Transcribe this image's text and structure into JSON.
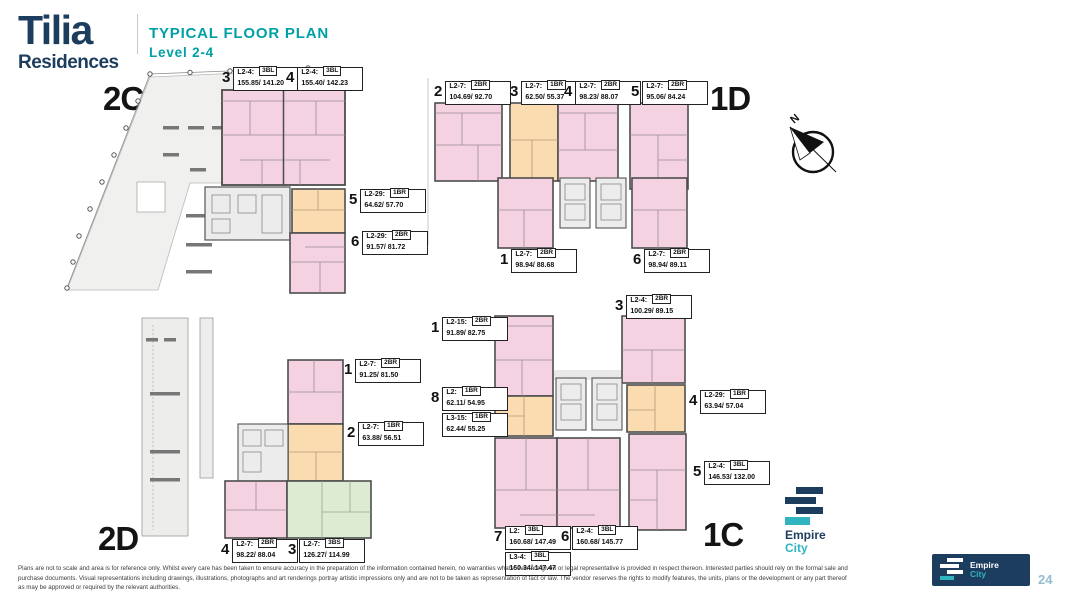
{
  "header": {
    "brand_name": "Tilia",
    "brand_sub": "Residences",
    "title": "TYPICAL FLOOR PLAN",
    "subtitle": "Level  2-4"
  },
  "compass": {
    "north_label": "N"
  },
  "sections": [
    {
      "id": "2C",
      "label": "2C",
      "units": [
        {
          "num": "3",
          "entries": [
            {
              "level": "L2-4:",
              "type": "3BL",
              "area": "155.85/ 141.20"
            }
          ]
        },
        {
          "num": "4",
          "entries": [
            {
              "level": "L2-4:",
              "type": "3BL",
              "area": "155.40/ 142.23"
            }
          ]
        },
        {
          "num": "5",
          "entries": [
            {
              "level": "L2-29:",
              "type": "1BR",
              "area": "64.62/ 57.70"
            }
          ]
        },
        {
          "num": "6",
          "entries": [
            {
              "level": "L2-29:",
              "type": "2BR",
              "area": "91.57/ 81.72"
            }
          ]
        }
      ]
    },
    {
      "id": "1D",
      "label": "1D",
      "units": [
        {
          "num": "2",
          "entries": [
            {
              "level": "L2-7:",
              "type": "2BR",
              "area": "104.69/ 92.70"
            }
          ]
        },
        {
          "num": "3",
          "entries": [
            {
              "level": "L2-7:",
              "type": "1BR",
              "area": "62.50/ 55.37"
            }
          ]
        },
        {
          "num": "4",
          "entries": [
            {
              "level": "L2-7:",
              "type": "2BR",
              "area": "98.23/ 88.07"
            }
          ]
        },
        {
          "num": "5",
          "entries": [
            {
              "level": "L2-7:",
              "type": "2BR",
              "area": "95.06/ 84.24"
            }
          ]
        },
        {
          "num": "1",
          "entries": [
            {
              "level": "L2-7:",
              "type": "2BR",
              "area": "98.94/ 88.68"
            }
          ]
        },
        {
          "num": "6",
          "entries": [
            {
              "level": "L2-7:",
              "type": "2BR",
              "area": "98.94/ 89.11"
            }
          ]
        }
      ]
    },
    {
      "id": "2D",
      "label": "2D",
      "units": [
        {
          "num": "1",
          "entries": [
            {
              "level": "L2-7:",
              "type": "2BR",
              "area": "91.25/ 81.50"
            }
          ]
        },
        {
          "num": "2",
          "entries": [
            {
              "level": "L2-7:",
              "type": "1BR",
              "area": "63.88/ 56.51"
            }
          ]
        },
        {
          "num": "4",
          "entries": [
            {
              "level": "L2-7:",
              "type": "2BR",
              "area": "98.22/ 88.04"
            }
          ]
        },
        {
          "num": "3",
          "entries": [
            {
              "level": "L2-7:",
              "type": "3BS",
              "area": "126.27/ 114.99"
            }
          ]
        }
      ]
    },
    {
      "id": "1C",
      "label": "1C",
      "units": [
        {
          "num": "1",
          "entries": [
            {
              "level": "L2-15:",
              "type": "2BR",
              "area": "91.89/ 82.75"
            }
          ]
        },
        {
          "num": "3",
          "entries": [
            {
              "level": "L2-4:",
              "type": "2BR",
              "area": "100.29/ 89.15"
            }
          ]
        },
        {
          "num": "8",
          "entries": [
            {
              "level": "L2:",
              "type": "1BR",
              "area": "62.11/ 54.95"
            },
            {
              "level": "L3-15:",
              "type": "1BR",
              "area": "62.44/ 55.25"
            }
          ]
        },
        {
          "num": "4",
          "entries": [
            {
              "level": "L2-29:",
              "type": "1BR",
              "area": "63.94/ 57.04"
            }
          ]
        },
        {
          "num": "5",
          "entries": [
            {
              "level": "L2-4:",
              "type": "3BL",
              "area": "146.53/ 132.00"
            }
          ]
        },
        {
          "num": "7",
          "entries": [
            {
              "level": "L2:",
              "type": "3BL",
              "area": "160.68/ 147.49"
            },
            {
              "level": "L3-4:",
              "type": "3BL",
              "area": "160.34/ 147.47"
            }
          ]
        },
        {
          "num": "6",
          "entries": [
            {
              "level": "L2-4:",
              "type": "3BL",
              "area": "160.68/ 145.77"
            }
          ]
        }
      ]
    }
  ],
  "plan_colors": {
    "unit_pink": "#f4d2e2",
    "unit_orange": "#fbdcb0",
    "unit_green": "#dcebd2",
    "core_gray": "#ececec",
    "wall": "#4d4d4d"
  },
  "logo": {
    "line1": "Empire",
    "line2": "City"
  },
  "footer": {
    "disclaimer": "Plans are not to scale and area is for reference only. Whilst every care has been taken to ensure accuracy in the preparation of the information contained herein, no warranties whatsoever are given or legal representative is provided in respect thereon. Interested parties should rely on the formal sale and purchase documents. Visual representations including drawings, illustrations, photographs and art renderings portray artistic impressions only and are not to be taken as representation of fact or law. The vendor reserves the rights to modify features, the units, plans or the development or any part thereof as may be approved or required by the relevant authorities.",
    "page_number": "24"
  }
}
